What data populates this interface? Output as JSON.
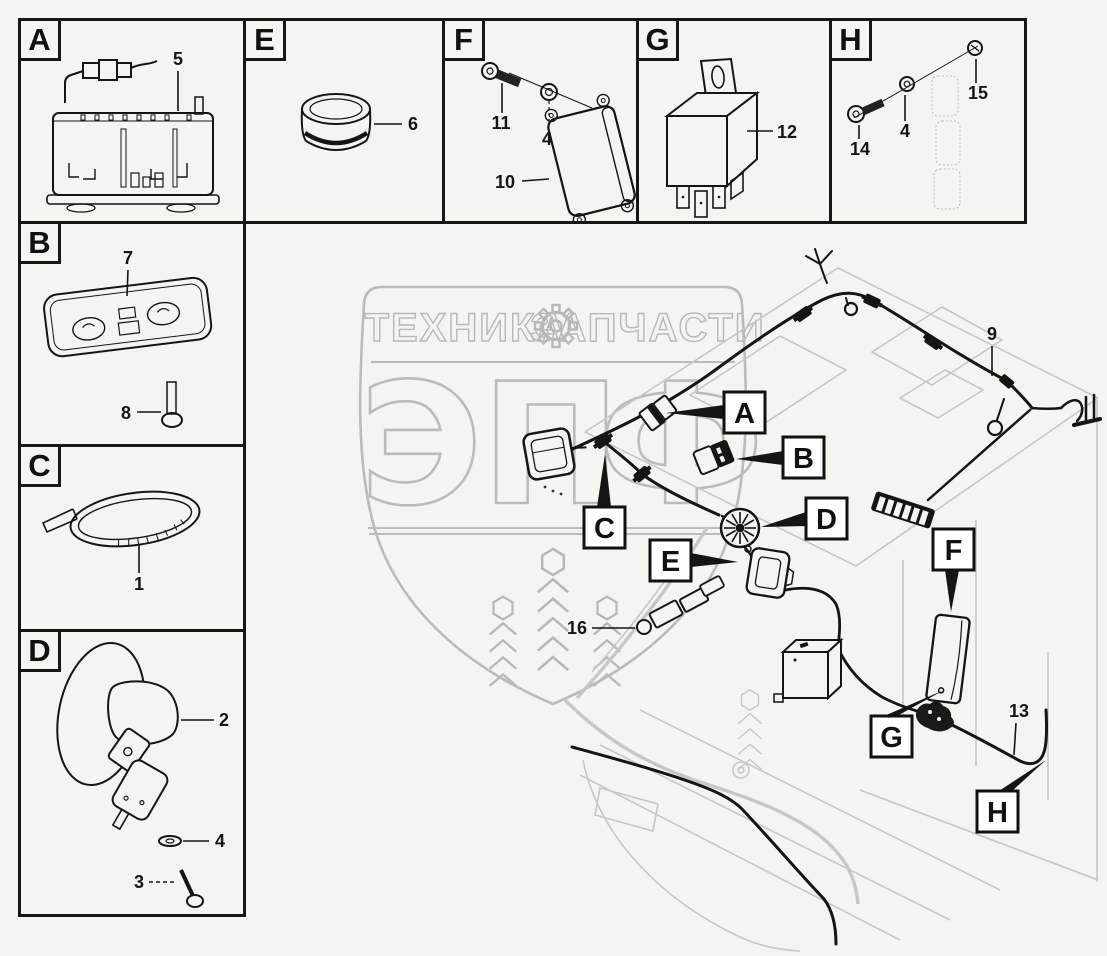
{
  "page": {
    "background": "#f2f5f0",
    "ink_color": "#151515",
    "cab_line_color": "#c5c9c5",
    "watermark_color": "#b6bab6"
  },
  "watermark": {
    "band_left": "ТЕХНИКА",
    "band_right": "ЗАПЧАСТИ",
    "gear_icon": "gear",
    "monogram": [
      "Э",
      "П",
      "Ф"
    ]
  },
  "panels": [
    {
      "letter": "A",
      "numbers": [
        "5"
      ]
    },
    {
      "letter": "E",
      "numbers": [
        "6"
      ]
    },
    {
      "letter": "F",
      "numbers": [
        "11",
        "4",
        "10"
      ]
    },
    {
      "letter": "G",
      "numbers": [
        "12"
      ]
    },
    {
      "letter": "H",
      "numbers": [
        "14",
        "4",
        "15"
      ]
    },
    {
      "letter": "B",
      "numbers": [
        "7",
        "8"
      ]
    },
    {
      "letter": "C",
      "numbers": [
        "1"
      ]
    },
    {
      "letter": "D",
      "numbers": [
        "2",
        "4",
        "3"
      ]
    }
  ],
  "main": {
    "callouts": [
      "A",
      "B",
      "C",
      "D",
      "E",
      "F",
      "G",
      "H"
    ],
    "numbers": [
      "9",
      "16",
      "13"
    ]
  }
}
